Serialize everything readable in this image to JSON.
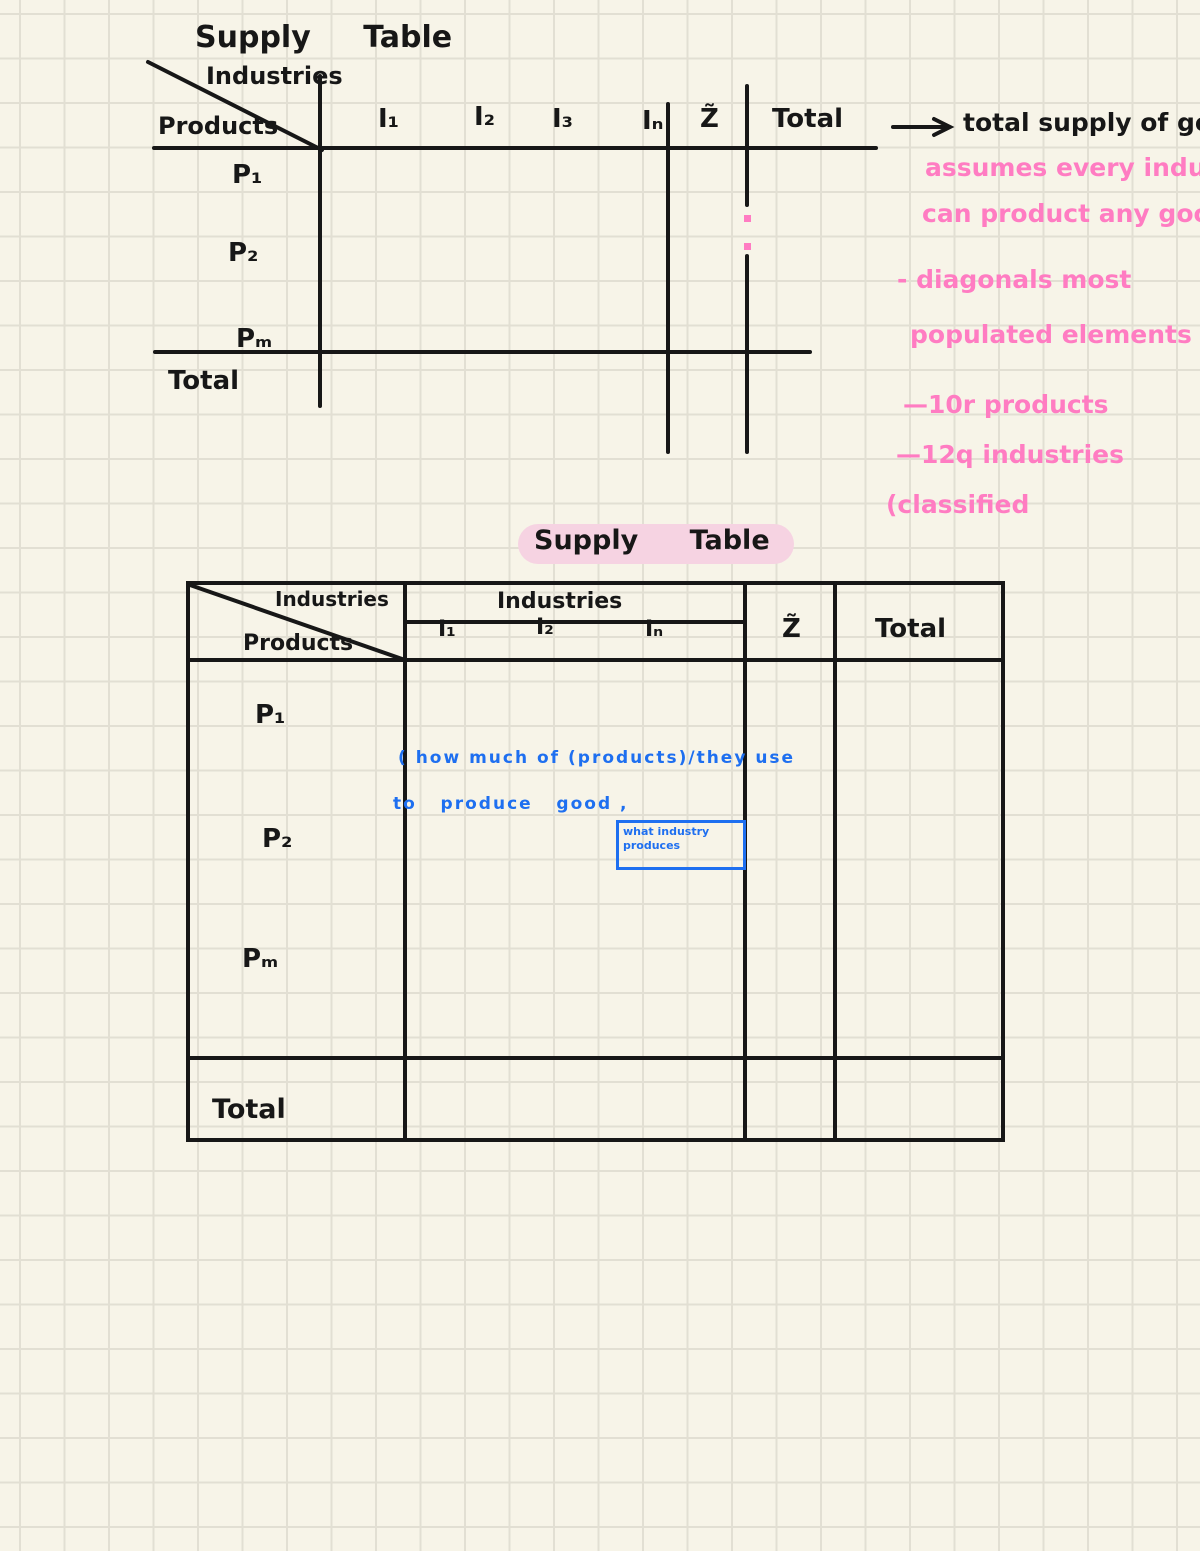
{
  "page": {
    "background": "#f7f4e8",
    "grid_color": "#e2dfd3",
    "ink_color": "#171717",
    "pink_color": "#ff7cc2",
    "blue_color": "#1e6ff0",
    "highlight_color": "#f6d3e2"
  },
  "table1": {
    "title": "Supply Table",
    "corner_top": "Industries",
    "corner_bottom": "Products",
    "columns": [
      "I₁",
      "I₂",
      "I₃",
      "Iₙ",
      "Z̃",
      "Total"
    ],
    "rows": [
      "P₁",
      "P₂",
      "Pₘ"
    ],
    "total_label": "Total",
    "arrow_note": "total supply of goods"
  },
  "pink_notes": {
    "line1": "assumes every industries",
    "line2": "can product any goods",
    "line3": "- diagonals most",
    "line4": "populated elements",
    "line5": "—10r products",
    "line6": "—12q industries",
    "line7": "(classified"
  },
  "table2": {
    "title": "Supply Table",
    "corner_top": "Industries",
    "corner_bottom": "Products",
    "group_header": "Industries",
    "sub_columns": [
      "I₁",
      "I₂",
      "Iₙ"
    ],
    "col_z": "Z̃",
    "col_total": "Total",
    "rows": [
      "P₁",
      "P₂",
      "Pₘ"
    ],
    "total_label": "Total"
  },
  "blue_notes": {
    "line1": "( how much of (products)/they use",
    "line2": "to   produce   good ,",
    "box_line1": "what industry",
    "box_line2": "produces"
  }
}
